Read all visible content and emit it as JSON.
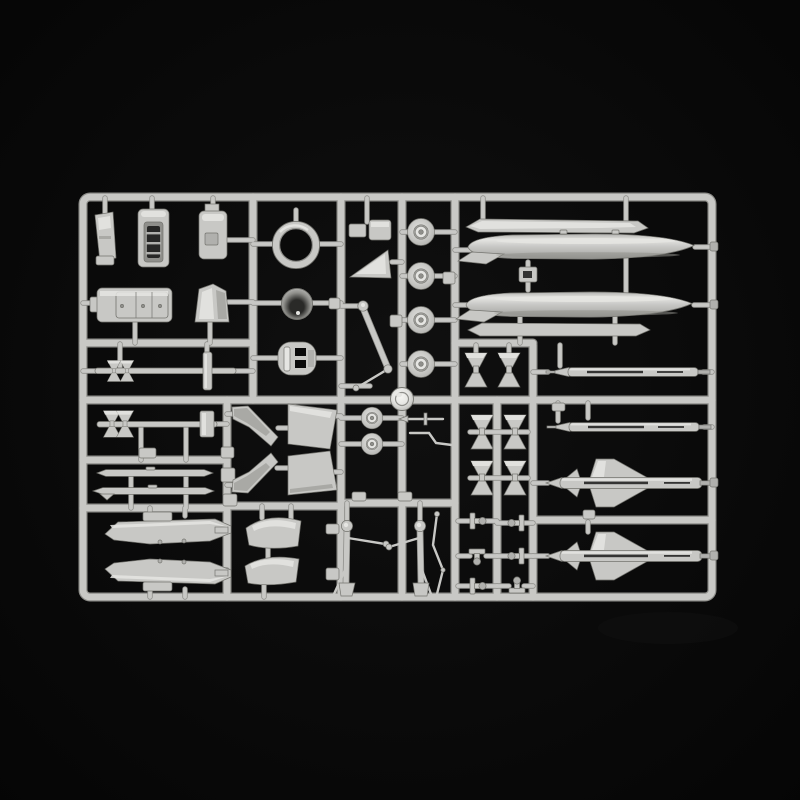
{
  "scene": {
    "medium": "photograph",
    "subject": "Light grey injection-moulded plastic model kit sprue with aircraft parts on a black background",
    "aria_label": "Photograph of a light grey plastic model kit sprue holding aircraft parts - drop tanks, missiles, wheels, landing gear and cockpit parts - on a black background"
  },
  "palette": {
    "bg": "#040404",
    "bg_glow": "#101010",
    "plastic": "#c8c8c5",
    "plastic_light": "#e5e5e2",
    "plastic_mid": "#b0b0ad",
    "plastic_dark": "#8f8f8b",
    "plastic_edge": "#74746f",
    "hole": "#0a0a0a",
    "cone_dark": "#2a2a28",
    "boss_bright": "#f6f6f3"
  },
  "sprue": {
    "material": "light grey polystyrene",
    "parts_inventory": [
      {
        "name": "drop-tank",
        "qty": 2
      },
      {
        "name": "tank-strake-plate",
        "qty": 2
      },
      {
        "name": "sparrow-missile",
        "qty": 2
      },
      {
        "name": "slender-missile",
        "qty": 2
      },
      {
        "name": "finned-rocket",
        "qty": 1
      },
      {
        "name": "missile-body-rod",
        "qty": 2
      },
      {
        "name": "main-wheel",
        "qty": 4
      },
      {
        "name": "nose-wheel",
        "qty": 2
      },
      {
        "name": "intake-ring",
        "qty": 1
      },
      {
        "name": "exhaust-cone",
        "qty": 1
      },
      {
        "name": "slotted-bulkhead",
        "qty": 1
      },
      {
        "name": "ejection-seat",
        "qty": 1
      },
      {
        "name": "seat-rail",
        "qty": 1
      },
      {
        "name": "headrest-console",
        "qty": 1
      },
      {
        "name": "cockpit-tub",
        "qty": 1
      },
      {
        "name": "windscreen-hood",
        "qty": 1
      },
      {
        "name": "stabilizer-with-fins",
        "qty": 1
      },
      {
        "name": "tailplane-panel",
        "qty": 2
      },
      {
        "name": "wing-glove",
        "qty": 2
      },
      {
        "name": "canopy-shell",
        "qty": 2
      },
      {
        "name": "intake-duct-half",
        "qty": 2
      },
      {
        "name": "fin-pair",
        "qty": 6
      },
      {
        "name": "nose-gear-strut",
        "qty": 1
      },
      {
        "name": "main-gear-strut",
        "qty": 2
      },
      {
        "name": "gear-actuator",
        "qty": 1
      },
      {
        "name": "pitot-probe",
        "qty": 1
      },
      {
        "name": "small-fitting",
        "qty": 12
      },
      {
        "name": "mould-boss",
        "qty": 1
      }
    ]
  }
}
